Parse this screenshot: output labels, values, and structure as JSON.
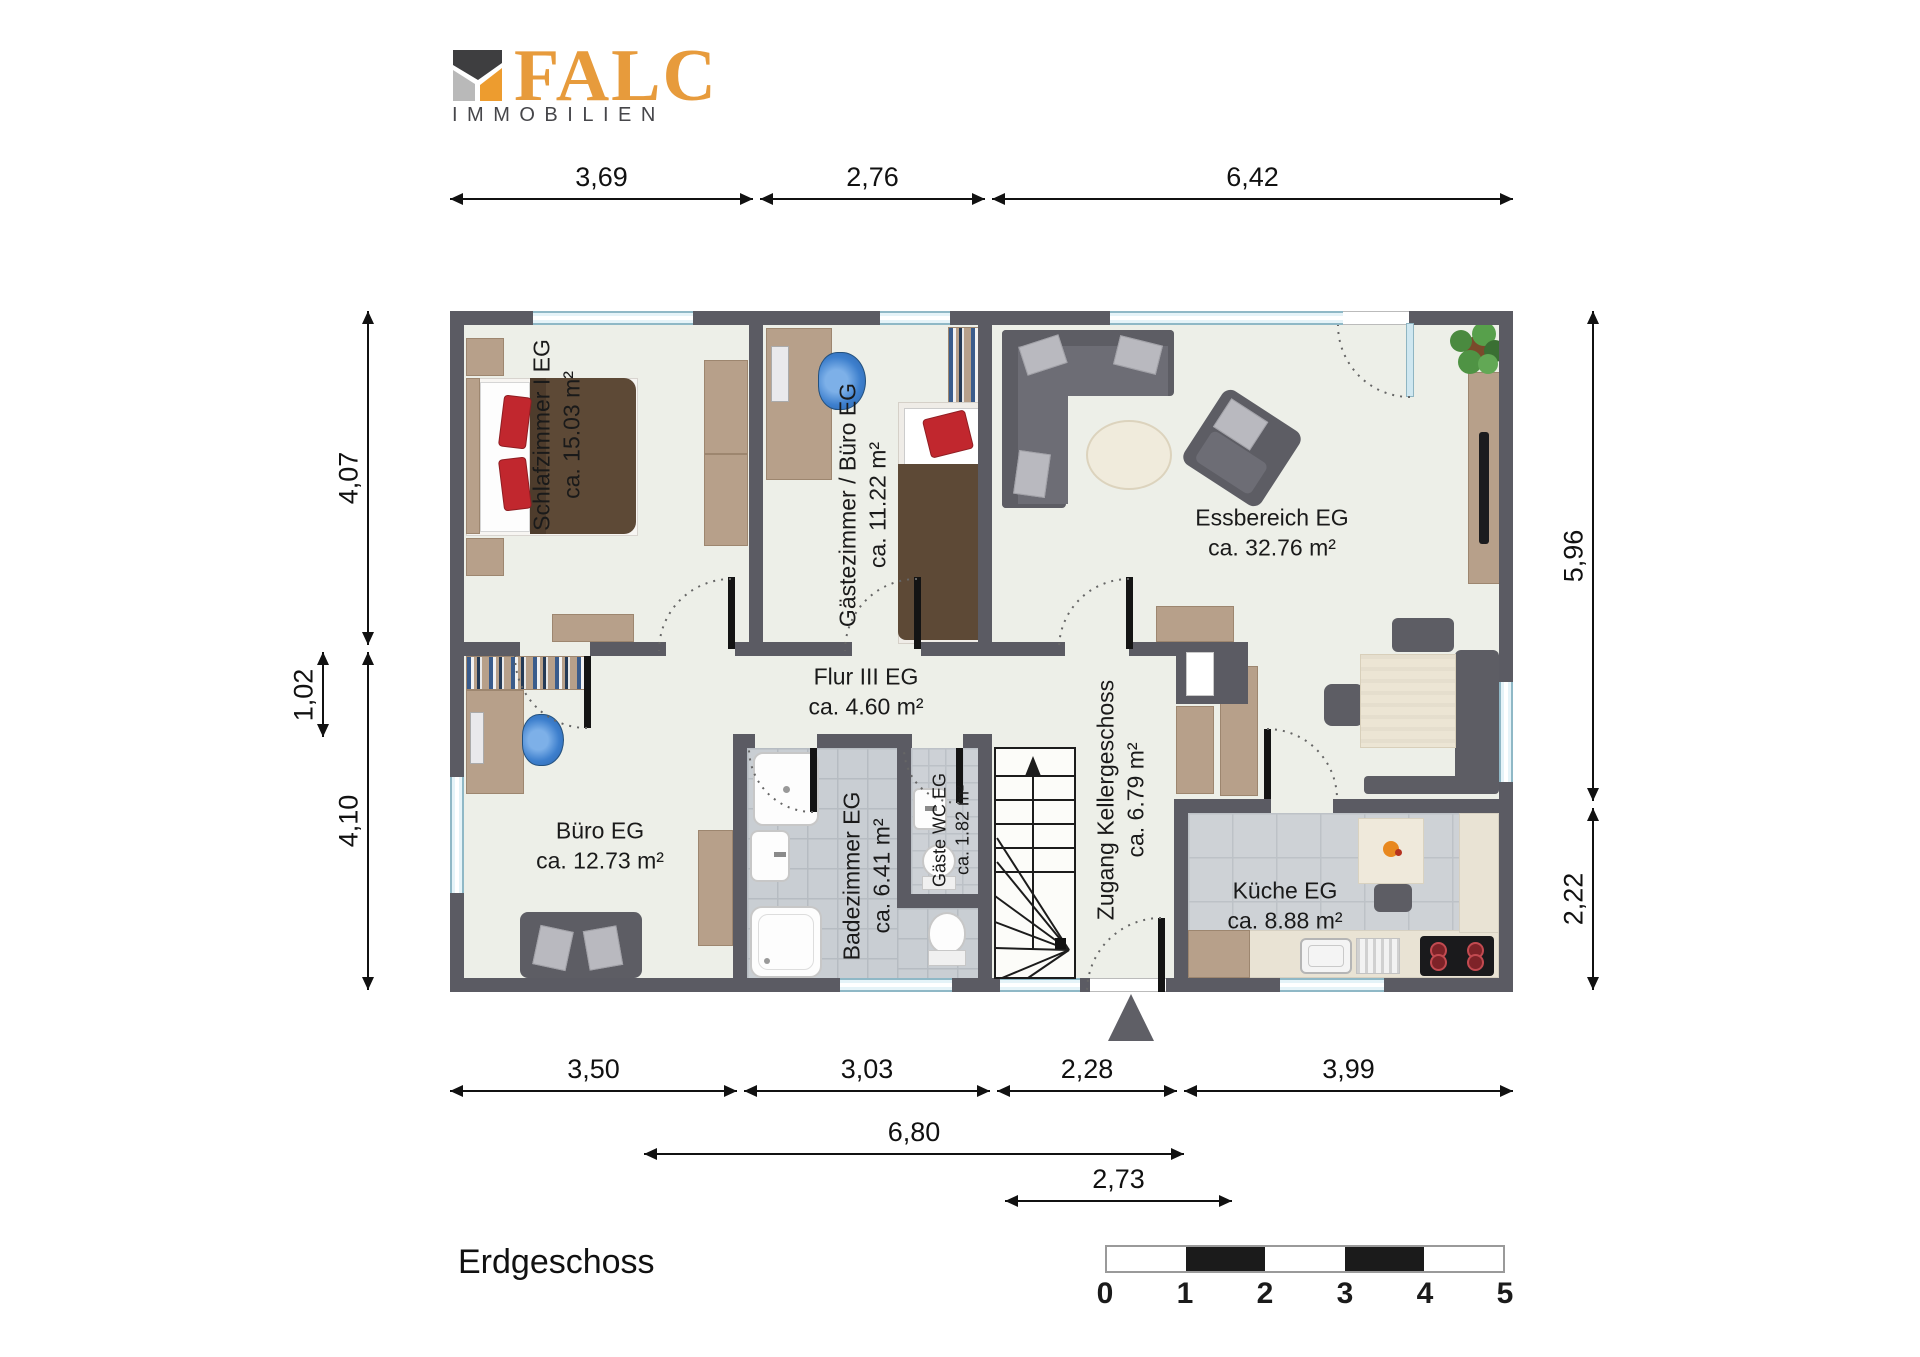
{
  "logo": {
    "brand": "FALC",
    "subtitle": "IMMOBILIEN",
    "brand_color": "#E79B3C"
  },
  "floor_label": "Erdgeschoss",
  "rooms": [
    {
      "name": "Schlafzimmer I EG",
      "area": "ca. 15.03 m²"
    },
    {
      "name": "Gästezimmer / Büro EG",
      "area": "ca. 11.22 m²"
    },
    {
      "name": "Essbereich EG",
      "area": "ca. 32.76 m²"
    },
    {
      "name": "Flur III EG",
      "area": "ca. 4.60 m²"
    },
    {
      "name": "Büro EG",
      "area": "ca. 12.73 m²"
    },
    {
      "name": "Badezimmer EG",
      "area": "ca. 6.41 m²"
    },
    {
      "name": "Gäste WC EG",
      "area": "ca. 1.82 m²"
    },
    {
      "name": "Zugang Kellergeschoss",
      "area": "ca. 6.79 m²"
    },
    {
      "name": "Küche EG",
      "area": "ca. 8.88 m²"
    }
  ],
  "dimensions": {
    "top": [
      "3,69",
      "2,76",
      "6,42"
    ],
    "bottom": [
      "3,50",
      "3,03",
      "2,28",
      "3,99"
    ],
    "bottom_overall": "6,80",
    "bottom_entry": "2,73",
    "left": [
      "4,07",
      "1,02",
      "4,10"
    ],
    "right": [
      "5,96",
      "2,22"
    ]
  },
  "scale_bar": {
    "labels": [
      "0",
      "1",
      "2",
      "3",
      "4",
      "5"
    ]
  },
  "colors": {
    "wall": "#5b5b63",
    "floor": "#edefe8",
    "accent_red": "#c1272e",
    "wood": "#b7a08a"
  }
}
